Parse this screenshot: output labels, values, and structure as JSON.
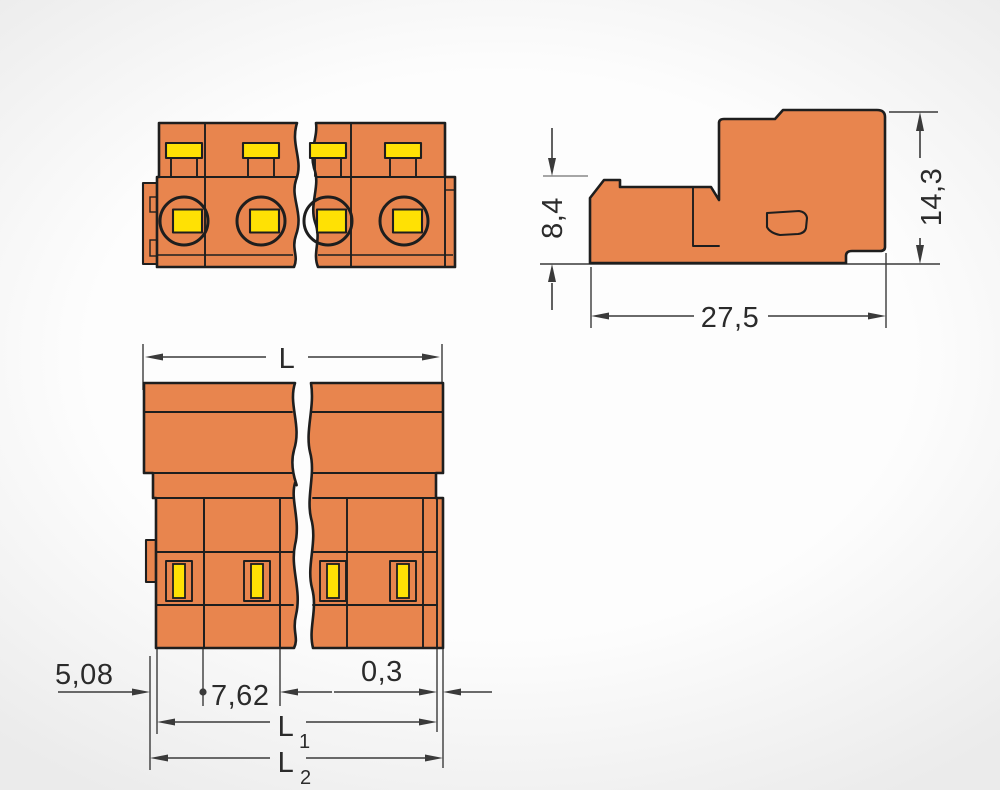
{
  "drawing": {
    "title": "connector-dimensional-drawing",
    "views": {
      "front": {
        "name": "front view"
      },
      "side": {
        "dims": {
          "height_low": "8,4",
          "height_total": "14,3",
          "depth": "27,5"
        }
      },
      "bottom": {
        "dims": {
          "overall_base": "L",
          "edge_offset": "5,08",
          "pitch": "7,62",
          "rim": "0,3",
          "l1_base": "L",
          "l1_sub": "1",
          "l2_base": "L",
          "l2_sub": "2"
        }
      }
    }
  },
  "colors": {
    "orange": "#E8854E",
    "blue": "#C8DDE9",
    "yellow": "#FFE104",
    "outline": "#1E1E1E",
    "dim": "#3A3A3A",
    "insert_gray": "#DCDCDC"
  }
}
